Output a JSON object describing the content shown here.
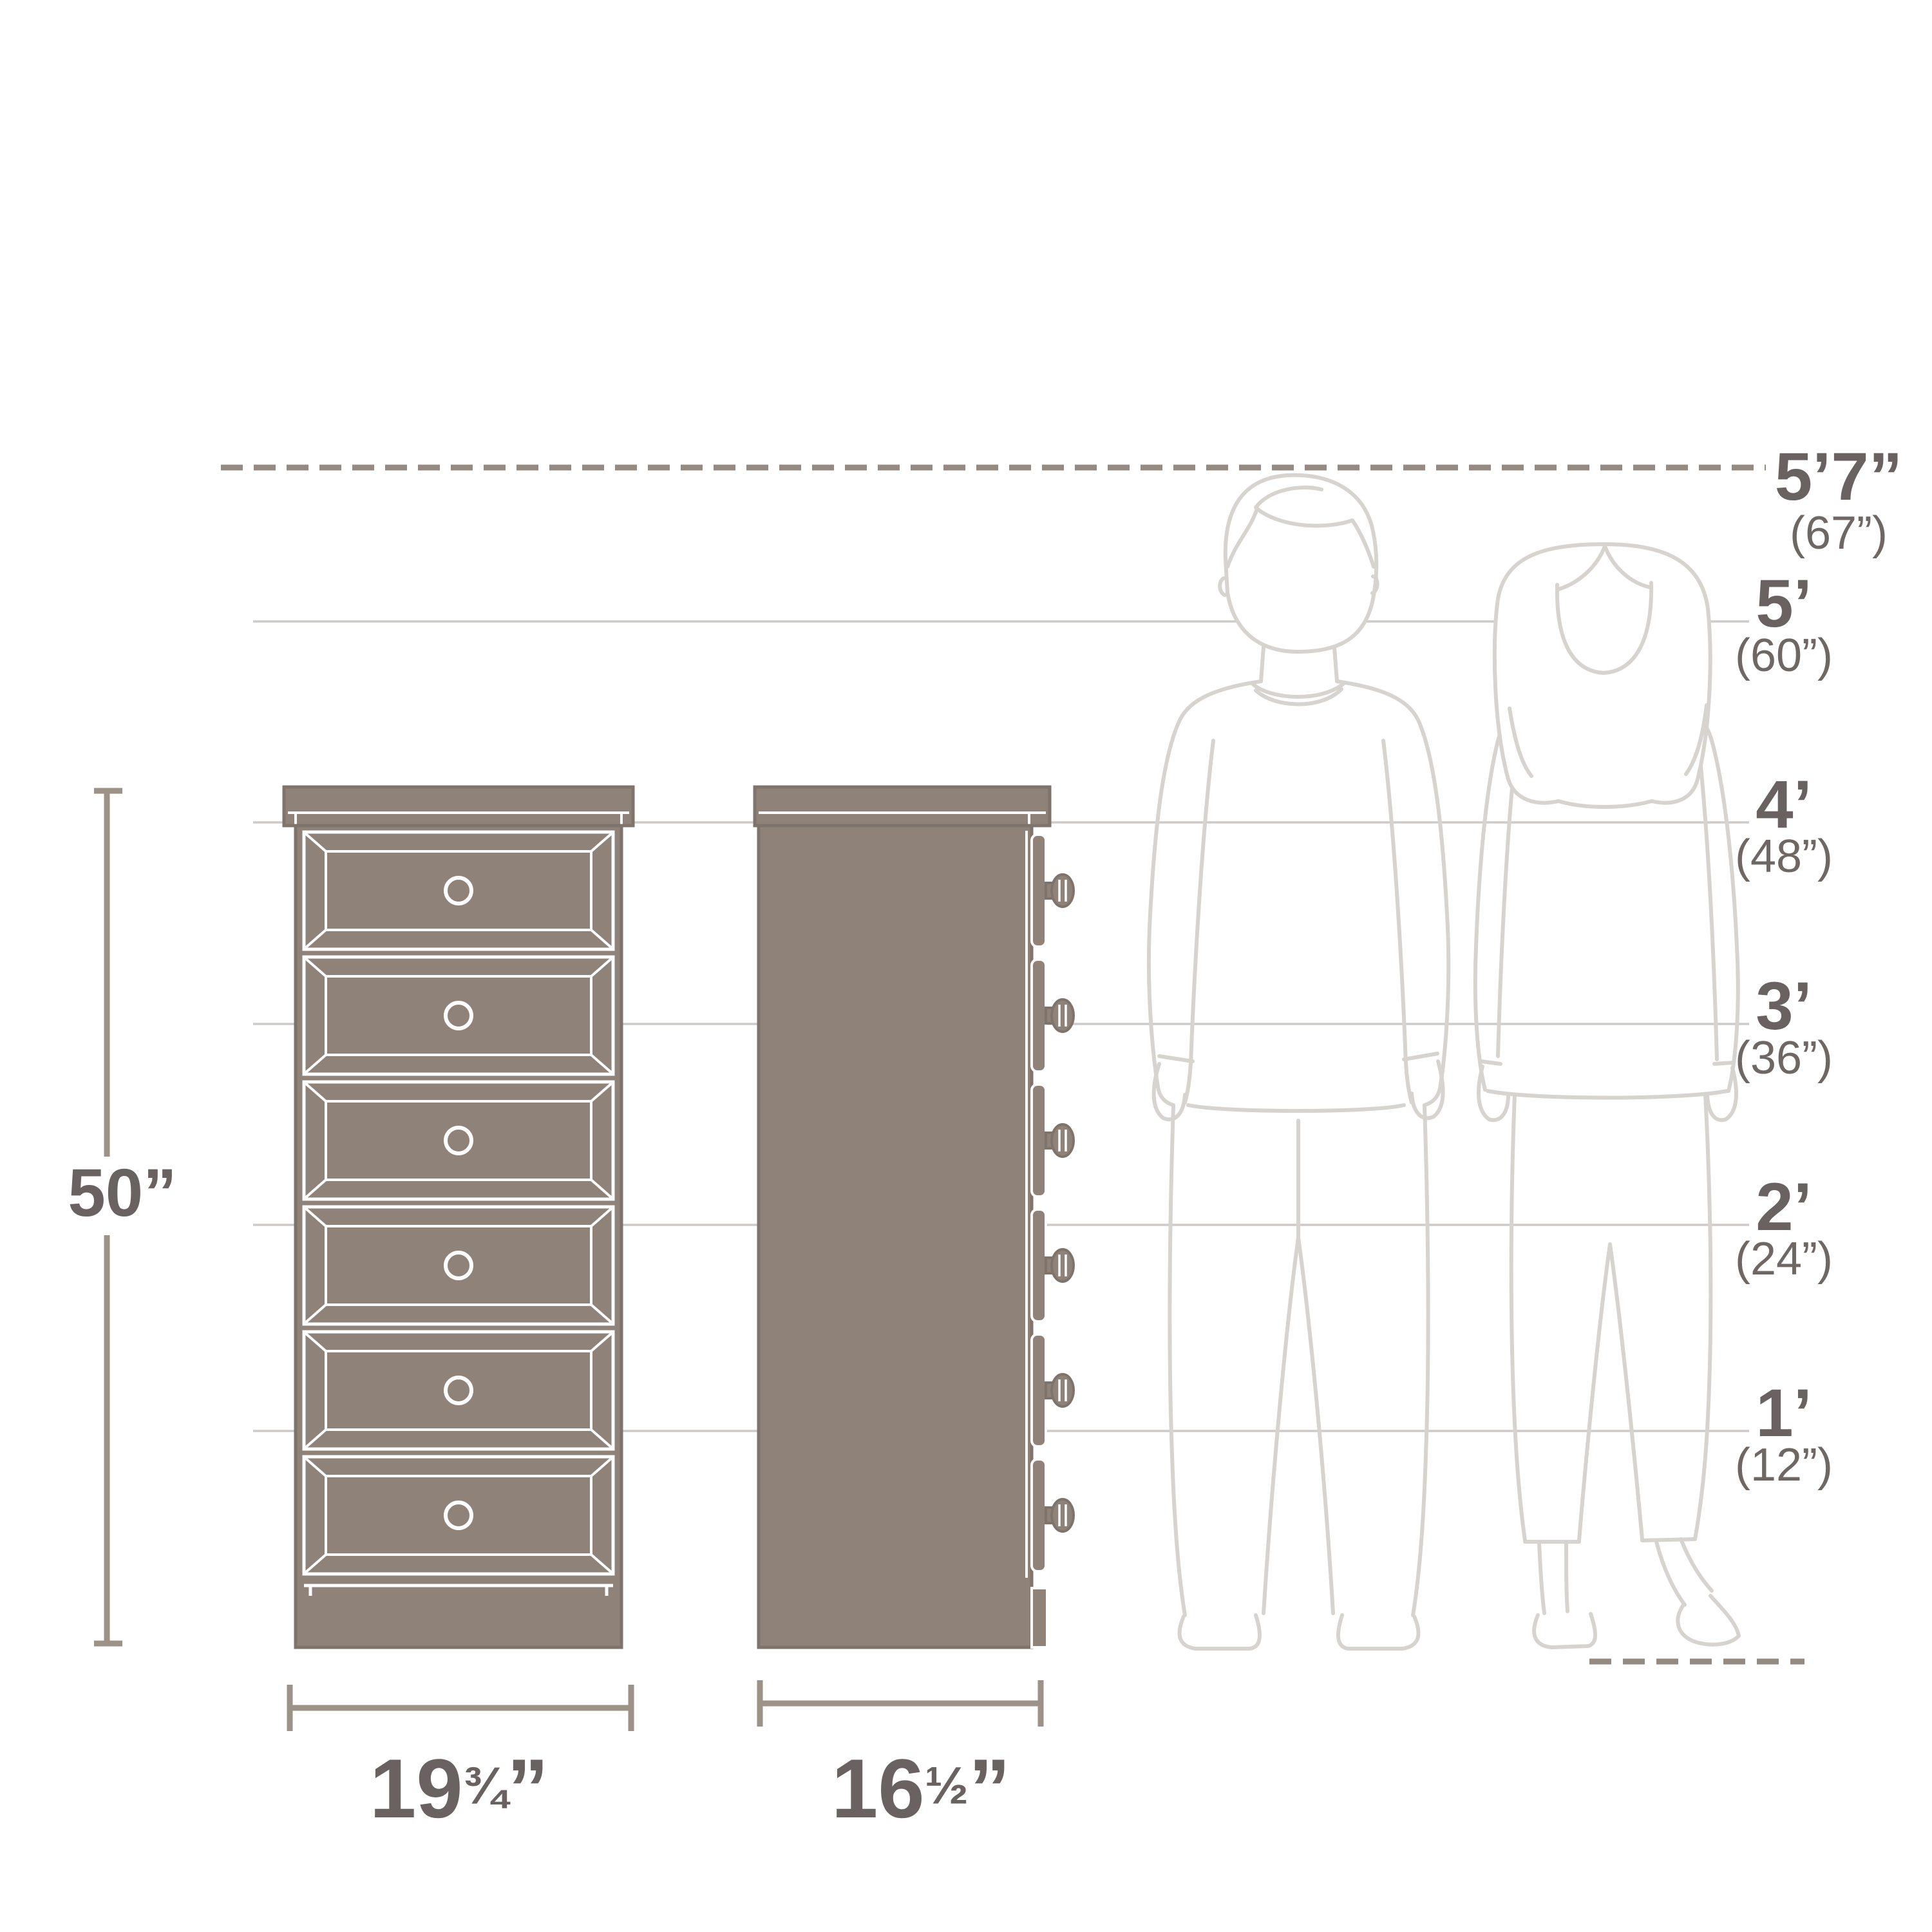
{
  "product": {
    "views": [
      "front-view-chest",
      "side-view-chest"
    ],
    "drawer_count": 6
  },
  "dimension_labels": {
    "height": "50”",
    "width": {
      "whole": "19",
      "fraction": "¾",
      "unit": "”"
    },
    "depth": {
      "whole": "16",
      "fraction": "½",
      "unit": "”"
    }
  },
  "height_markers": [
    {
      "feet": "5’7”",
      "inches": "(67”)"
    },
    {
      "feet": "5’",
      "inches": "(60”)"
    },
    {
      "feet": "4’",
      "inches": "(48”)"
    },
    {
      "feet": "3’",
      "inches": "(36”)"
    },
    {
      "feet": "2’",
      "inches": "(24”)"
    },
    {
      "feet": "1’",
      "inches": "(12”)"
    }
  ],
  "icons": {
    "man_figure": "man-outline-illustration",
    "woman_figure": "woman-outline-illustration"
  },
  "colors": {
    "furniture_fill": "#8e8279",
    "furniture_outline": "#7f746c",
    "furniture_detail": "#ffffff",
    "dimension_line": "#9d9287",
    "dashed_line": "#948a80",
    "reference_line": "#cecbc8",
    "figure_line": "#d7d3cf",
    "text": "#696260",
    "background": "#ffffff"
  }
}
